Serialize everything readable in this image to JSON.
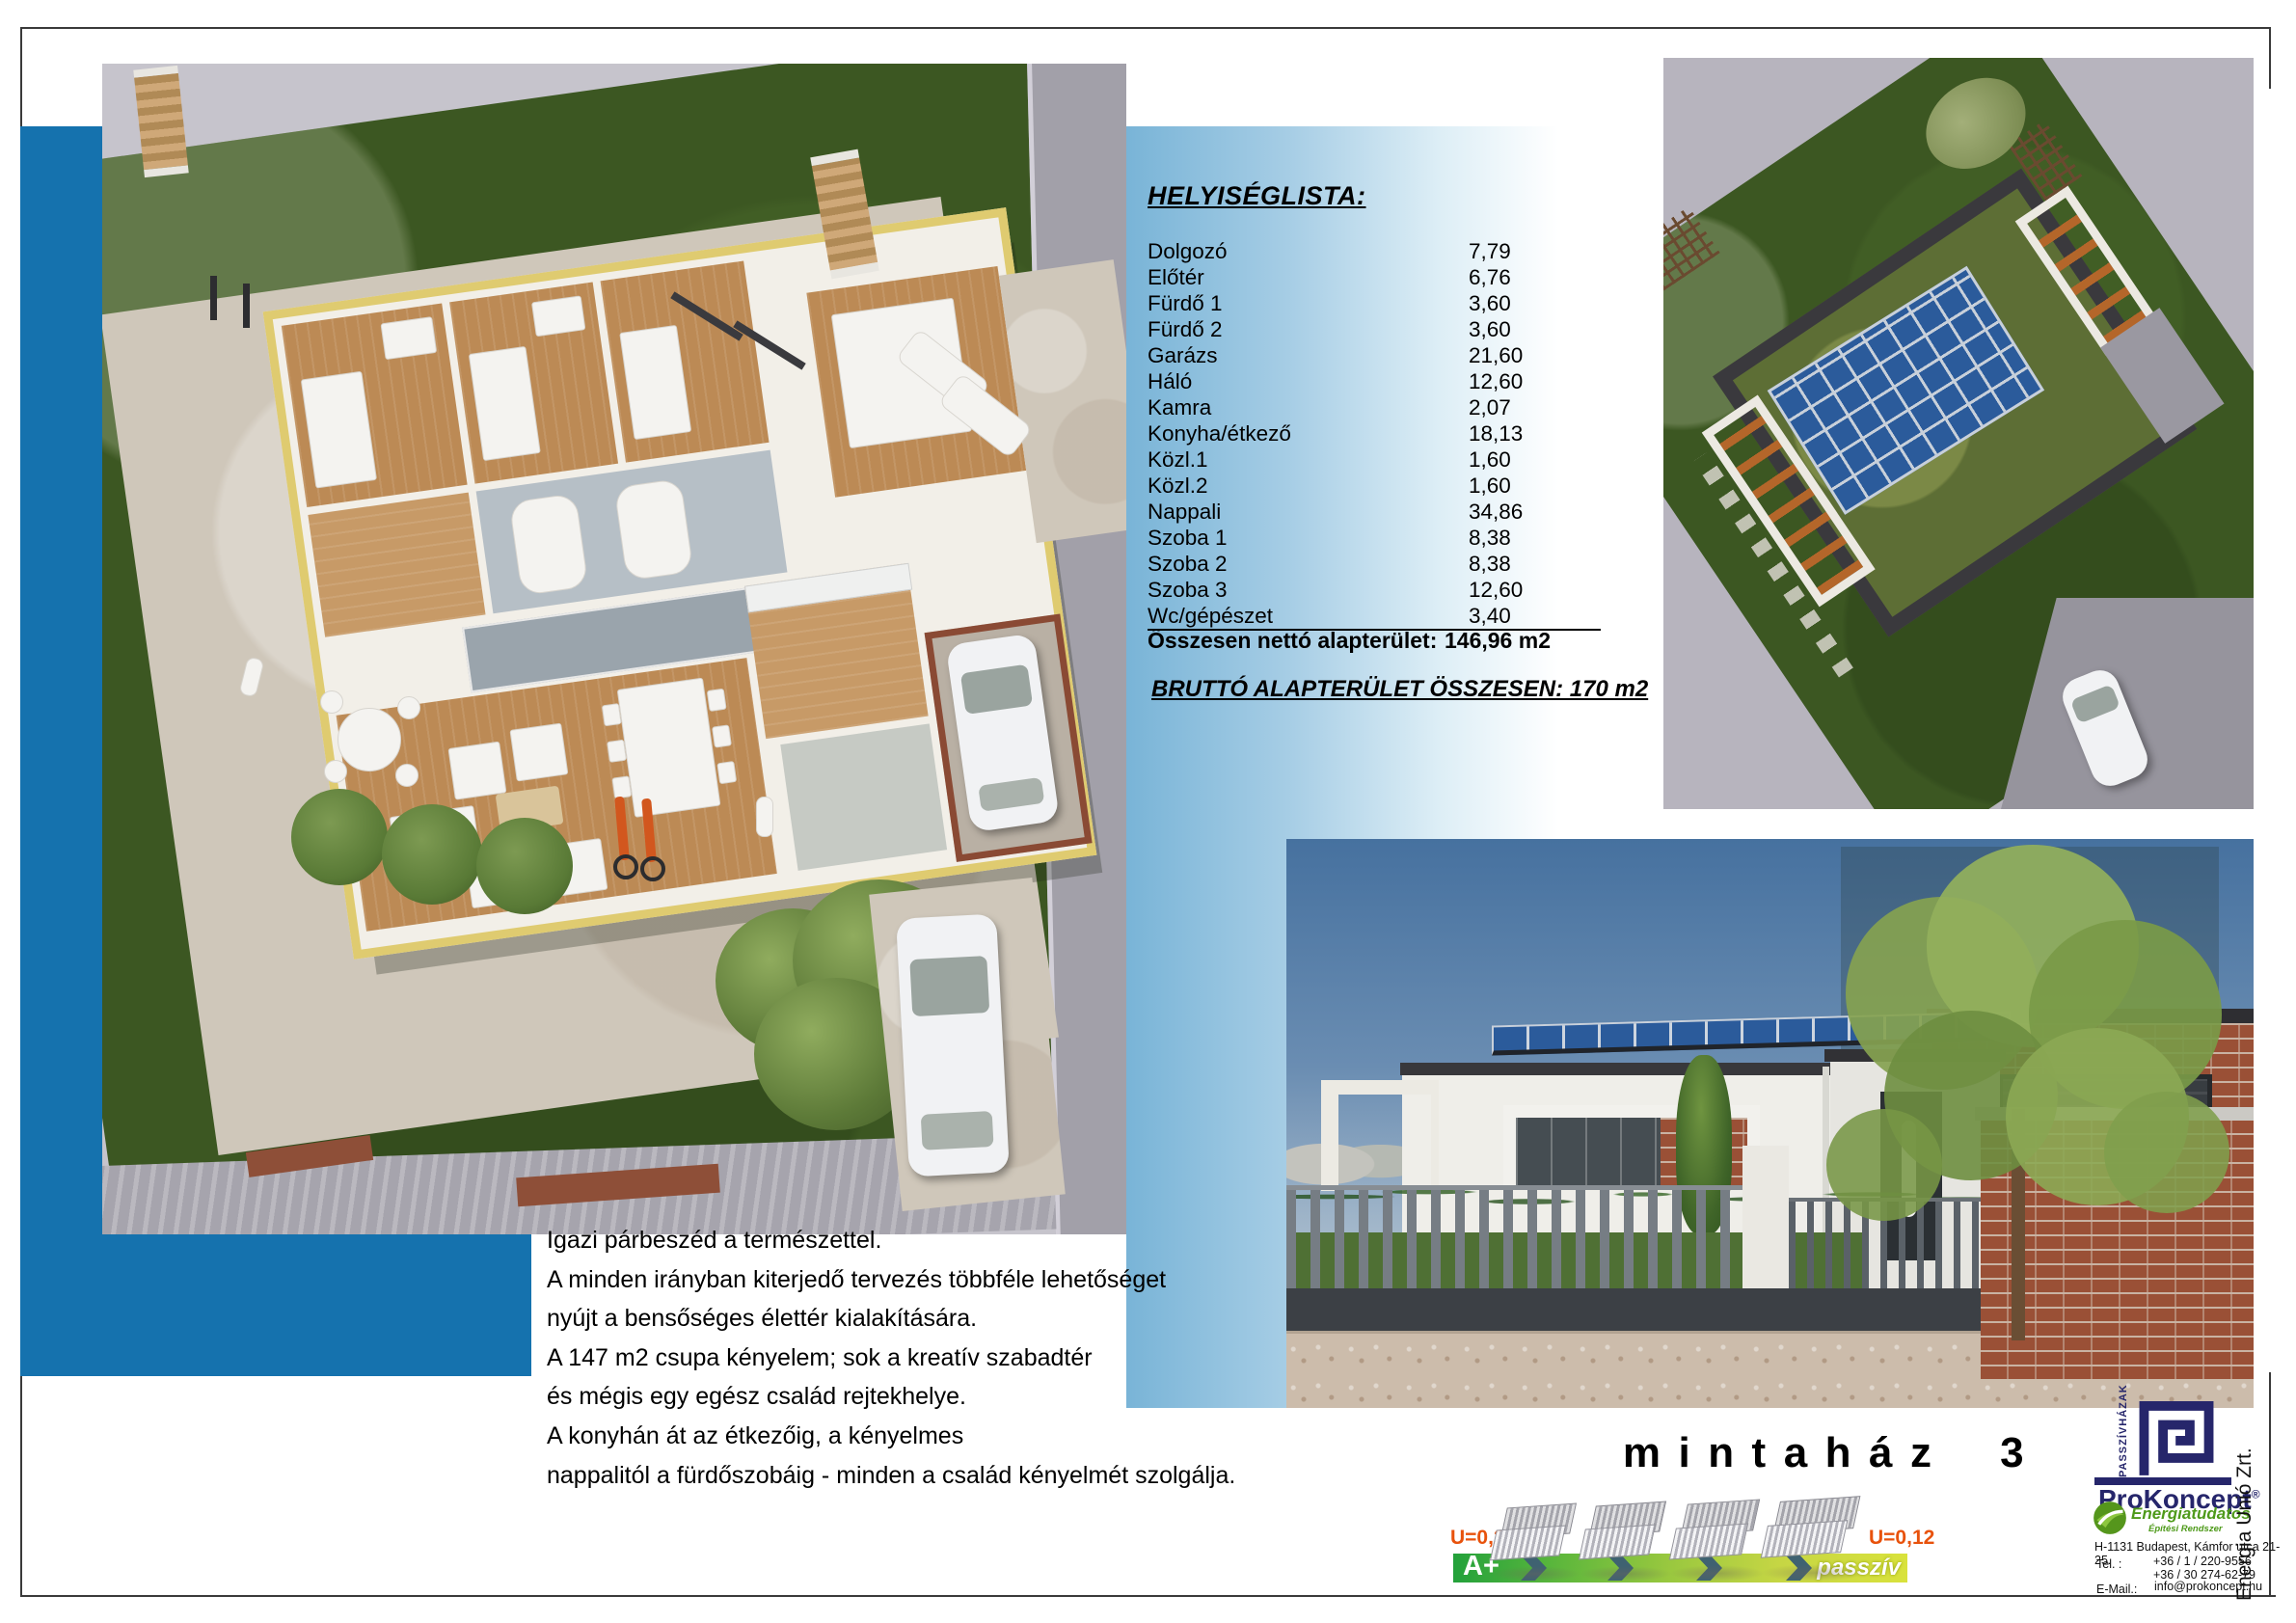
{
  "title": "mintaház 3",
  "room_list": {
    "heading": "HELYISÉGLISTA:",
    "rows": [
      {
        "name": "Dolgozó",
        "area": "7,79"
      },
      {
        "name": "Előtér",
        "area": "6,76"
      },
      {
        "name": "Fürdő 1",
        "area": "3,60"
      },
      {
        "name": "Fürdő 2",
        "area": "3,60"
      },
      {
        "name": "Garázs",
        "area": "21,60"
      },
      {
        "name": "Háló",
        "area": "12,60"
      },
      {
        "name": "Kamra",
        "area": "2,07"
      },
      {
        "name": "Konyha/étkező",
        "area": "18,13"
      },
      {
        "name": "Közl.1",
        "area": "1,60"
      },
      {
        "name": "Közl.2",
        "area": "1,60"
      },
      {
        "name": "Nappali",
        "area": "34,86"
      },
      {
        "name": "Szoba 1",
        "area": "8,38"
      },
      {
        "name": "Szoba 2",
        "area": "8,38"
      },
      {
        "name": "Szoba 3",
        "area": "12,60"
      },
      {
        "name": "Wc/gépészet",
        "area": "3,40"
      }
    ],
    "total_label": "Összesen nettó alapterület:",
    "total_value": "146,96 m2",
    "gross_line": "BRUTTÓ ALAPTERÜLET ÖSSZESEN: 170 m2"
  },
  "description": {
    "lines": [
      "Igazi párbeszéd a természettel.",
      "A minden irányban kiterjedő tervezés többféle lehetőséget",
      "nyújt a bensőséges élettér kialakítására.",
      "A 147 m2 csupa kényelem; sok a kreatív szabadtér",
      "és mégis egy egész család rejtekhelye.",
      "A konyhán át az étkezőig, a kényelmes",
      "nappalitól a fürdőszobáig - minden a család kényelmét szolgálja."
    ]
  },
  "energy": {
    "u_left": "U=0,27",
    "u_right": "U=0,12",
    "rating": "A+",
    "passive_label": "passzív",
    "bar_color_start": "#23a13b",
    "bar_color_end": "#d9e23c",
    "u_label_color": "#e8520c"
  },
  "branding": {
    "passzivhazak": "PASSZÍVHÁZAK",
    "company": "ProKoncept",
    "registered": "®",
    "tagline1": "Energiatudatos",
    "tagline2": "Építési Rendszer",
    "side_company": "Energia Unió Zrt.",
    "address": "H-1131 Budapest, Kámfor utca 21-25.",
    "tel_label": "Tel. :",
    "tel1": "+36 / 1 / 220-9556",
    "tel2": "+36 / 30 274-62-79",
    "email_label": "E-Mail.:",
    "email": "info@prokoncept.hu",
    "logo_navy": "#26266b",
    "logo_green": "#4e9a1a"
  },
  "colors": {
    "accent_blue": "#1572ae",
    "band_blue": "#79b4d7"
  }
}
